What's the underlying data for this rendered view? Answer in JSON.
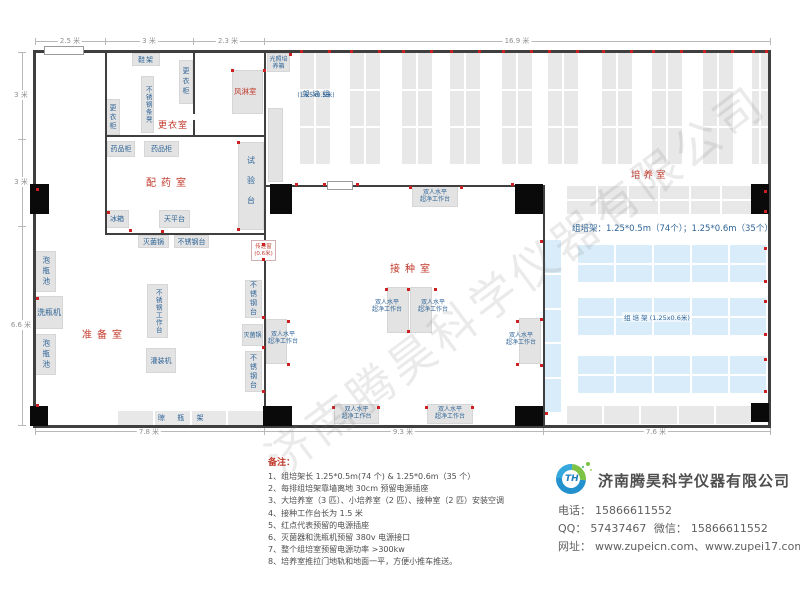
{
  "colors": {
    "wall": "#3f3f3f",
    "pillar": "#0a0a0a",
    "room_label_red": "#c0392b",
    "item_label_blue": "#2e6497",
    "rack_gray": "#e8e8e8",
    "rack_blue": "#d9ecf9",
    "furniture_gray": "#e3e3e3",
    "power_dot_red": "#cc2020"
  },
  "dimensions": {
    "top": [
      "2.5 米",
      "3 米",
      "2.3 米",
      "16.9 米"
    ],
    "left": [
      "3 米",
      "3 米",
      "6.6 米"
    ],
    "bottom": [
      "7.8 米",
      "9.3 米",
      "7.6 米"
    ]
  },
  "rooms": {
    "dressing": "更衣室",
    "air_shower": "风淋室",
    "dispensing": "配药室",
    "prep": "准备室",
    "inoculation": "接种室",
    "culture": "培养室"
  },
  "items": {
    "shoe_rack": "鞋架",
    "locker": "更衣柜",
    "steel_bench": "不锈钢条凳",
    "light_incubator": "光照培养箱",
    "medicine_cabinet": "药品柜",
    "test_bench": "试验台",
    "fridge": "冰箱",
    "balance": "天平台",
    "sterilizer": "灭菌锅",
    "steel_table": "不锈钢台",
    "soak_pool": "泡瓶池",
    "bottle_washer": "洗瓶机",
    "steel_worktable": "不锈钢工作台",
    "filler": "灌装机",
    "drying_rack": "晾 瓶 架",
    "clean_bench_line1": "双人水平",
    "clean_bench_line2": "超净工作台",
    "transfer_window": "传递窗",
    "transfer_window_size": "(0.6米)"
  },
  "racks": {
    "spec": "组培架：1.25*0.5m（74个）；1.25*0.6m（35个）",
    "small_label": "组培架",
    "small_size": "(1.25x0.5米)",
    "large_label": "组 培 架 (1.25x0.6米)"
  },
  "notes": {
    "heading": "备注：",
    "items": [
      "1、组培架长 1.25*0.5m(74 个) & 1.25*0.6m（35 个）",
      "2、每排组培架靠墙离地 30cm 预留电源插座",
      "3、大培养室（3 匹）、小培养室（2 匹）、接种室（2 匹）安装空调",
      "4、接种工作台长为 1.5 米",
      "5、红点代表预留的电源插座",
      "6、灭菌器和洗瓶机预留 380v 电源接口",
      "7、整个组培室预留电源功率 >300kw",
      "8、培养室推拉门地轨和地面一平，方便小推车推送。"
    ]
  },
  "contact": {
    "company": "济南腾昊科学仪器有限公司",
    "logo_text": "TH",
    "phone_label": "电话：",
    "phone": "15866611552",
    "qq_label": "QQ：",
    "qq": "57437467",
    "wechat_label": "微信：",
    "wechat": "15866611552",
    "web_label": "网址：",
    "websites": "www.zupeicn.com、www.zupei17.com"
  },
  "watermark": "济南腾昊科学仪器有限公司"
}
